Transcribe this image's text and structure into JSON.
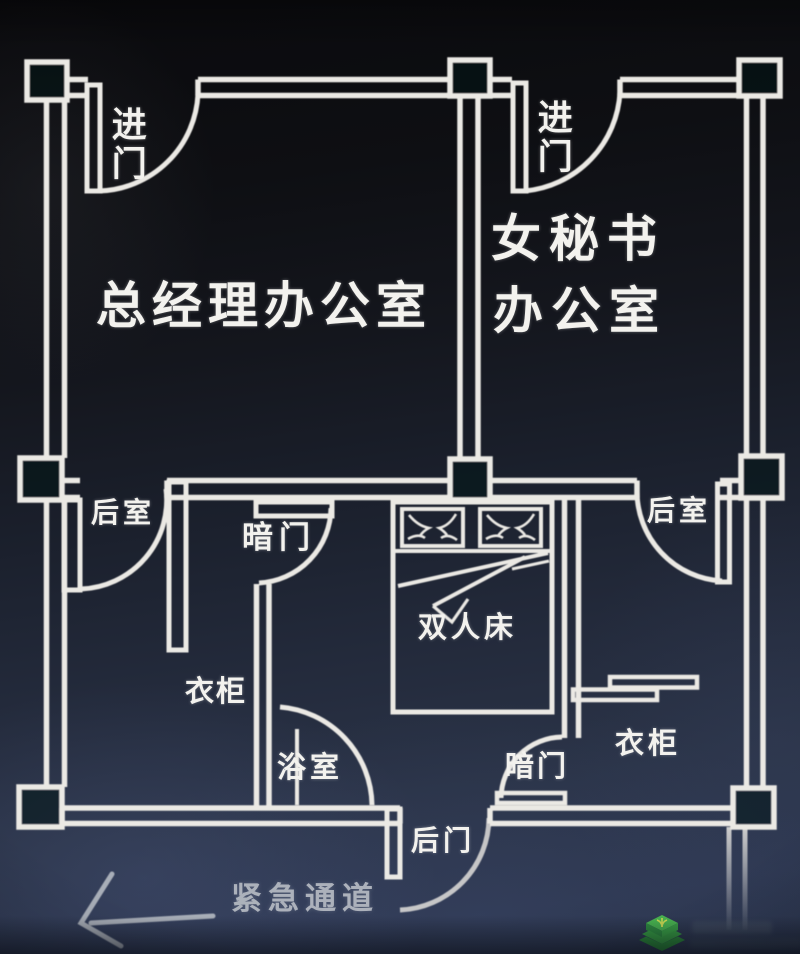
{
  "diagram": {
    "type": "floor-plan-sketch",
    "style": "white line drawing on dark photographed background"
  },
  "labels": {
    "gm_office": "总经理办公室",
    "secretary_office_line1": "女秘书",
    "secretary_office_line2": "办公室",
    "entrance_left": "进门",
    "entrance_right": "进门",
    "back_room_left": "后室",
    "back_room_right": "后室",
    "hidden_door_upper": "暗门",
    "hidden_door_lower": "暗门",
    "double_bed": "双人床",
    "wardrobe_left": "衣柜",
    "wardrobe_right": "衣柜",
    "bathroom": "浴室",
    "back_door": "后门",
    "emergency_passage": "紧急通道"
  },
  "icons": {
    "emergency_arrow": "left-arrow",
    "watermark_logo": "green-stacked-layers-logo"
  },
  "colors": {
    "background_top": "#0a0a0d",
    "background_bottom": "#2d3750",
    "wall_line": "#ebe9e4",
    "label_text": "#f3f2ee",
    "faded_text": "#c7cbd1",
    "watermark_green": "#3aa846"
  }
}
